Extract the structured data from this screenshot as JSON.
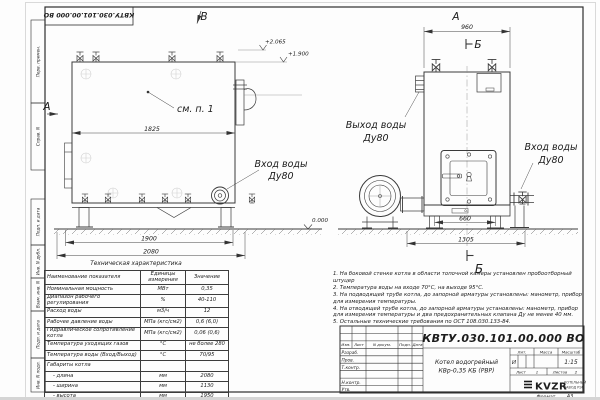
{
  "sheet": {
    "doc_number": "КВТУ.030.101.00.000 ВО",
    "format_label": "Формат",
    "format_value": "А3",
    "frame_labels": [
      "Перв. примен.",
      "Справ. N",
      "Подп. и дата",
      "Инв. N дубл.",
      "Взам. инв. N",
      "Подп. и дата",
      "Инв. N подл."
    ]
  },
  "views": {
    "left": {
      "view_b_label": "В",
      "view_a_label": "А",
      "callout_see_item": "см. п. 1",
      "dim_body_length": "1825",
      "dim_support_span": "1900",
      "dim_total_length": "2080",
      "level_top": "+2.065",
      "level_body_top": "+1.900",
      "inlet_line1": "Вход воды",
      "inlet_line2": "Ду80"
    },
    "right": {
      "view_a_label": "А",
      "section_b_top": "Б",
      "section_b_bottom": "Б",
      "dim_width": "960",
      "dim_leg_span": "660",
      "dim_total_width": "1305",
      "level_zero": "0.000",
      "outlet_line1": "Выход воды",
      "outlet_line2": "Ду80",
      "inlet_line1": "Вход воды",
      "inlet_line2": "Ду80"
    }
  },
  "tech_table": {
    "title": "Техническая характеристика",
    "headers": [
      "Наименование показателя",
      "Единицы измерения",
      "Значение"
    ],
    "rows": [
      [
        "Номинальная мощность",
        "МВт",
        "0,35"
      ],
      [
        "Диапазон рабочего регулирования",
        "%",
        "40-110"
      ],
      [
        "Расход воды",
        "м3/ч",
        "12"
      ],
      [
        "Рабочее давление воды",
        "МПа (кгс/см2)",
        "0,6 (6,0)"
      ],
      [
        "Гидравлическое сопротивление котла",
        "МПа (кгс/см2)",
        "0,06 (0,6)"
      ],
      [
        "Температура уходящих газов",
        "°С",
        "не более 280"
      ],
      [
        "Температура воды (Вход/Выход)",
        "°С",
        "70/95"
      ],
      [
        "Габариты котла",
        "",
        ""
      ],
      [
        "- длина",
        "мм",
        "2080"
      ],
      [
        "- ширина",
        "мм",
        "1130"
      ],
      [
        "- высота",
        "мм",
        "1950"
      ]
    ]
  },
  "notes": [
    "1.  На боковой стенке котла в области топочной камеры установлен пробоотборный штуцер",
    "2.  Температура воды на входе 70°С, на выходе 95°С.",
    "3.  На подводящей трубе котла, до запорной арматуры установлены: манометр, прибор для измерения температуры.",
    "4.  На отводящей трубе котла, до запорной арматуры установлены: манометр, прибор для измерения температуры и два предохранительных клапана Ду не менее 40 мм.",
    "5.  Остальные технические требования по ОСТ 108.030.133-84."
  ],
  "title_block": {
    "product_name_line1": "Котел водогрейный",
    "product_name_line2": "КВр-0,35 КБ (РВР)",
    "header": {
      "izm": "Изм.",
      "list": "Лист",
      "ndoc": "N докум.",
      "podp": "Подп.",
      "data": "Дата"
    },
    "roles": {
      "razrab": "Разраб.",
      "prov": "Пров.",
      "tkontr": "Т.контр.",
      "nkontr": "Н.контр.",
      "utv": "Утв."
    },
    "lit_label": "Лит.",
    "lit_value": "И",
    "mass_label": "Масса",
    "scale_label": "Масштаб",
    "scale_value": "1:15",
    "sheet_label": "Лист",
    "sheet_value": "1",
    "sheets_label": "Листов",
    "sheets_value": "2",
    "logo_text": "KVZR",
    "logo_sub1": "КОТЕЛЬНЫЙ",
    "logo_sub2": "ЗАВОД РЭП"
  }
}
